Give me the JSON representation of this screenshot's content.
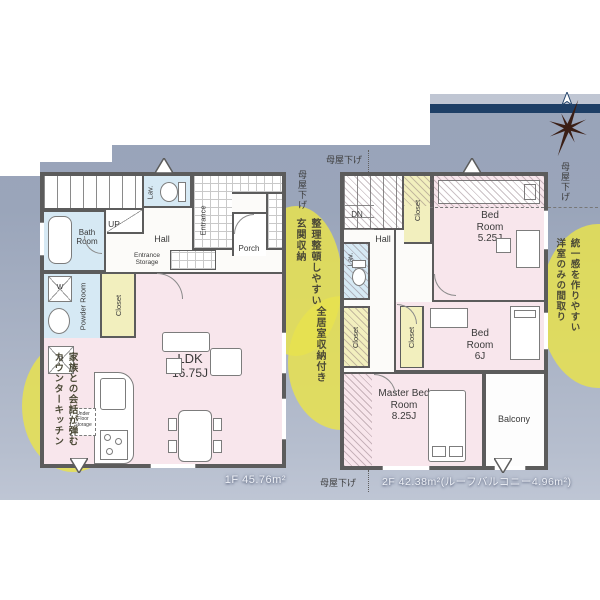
{
  "palette": {
    "background_panel_top": "#97a2b8",
    "background_panel_bottom": "#ccd2df",
    "navy_stripe": "#1e3f66",
    "callout_yellow": "#e7e24f",
    "room_pink": "#f8e6ec",
    "room_blue": "#d6e9f4",
    "closet_yellow": "#f2efbe",
    "wall_gray": "#5c5c5c",
    "compass_brown": "#3a1e15"
  },
  "eaves": {
    "label": "母屋下げ"
  },
  "floor1": {
    "area_label": "1F 45.76m²",
    "labels": {
      "up": "UP",
      "lav": "Lav.",
      "hall": "Hall",
      "bath": "Bath Room",
      "powder": "Powder Room",
      "closet": "Closet",
      "entrance": "Entrance",
      "entrance_storage": "Entrance Storage",
      "porch": "Porch",
      "ldk_name": "LDK",
      "ldk_size": "16.75J",
      "under_floor_storage": "Under Floor Storage",
      "washer": "W",
      "fridge": "R"
    }
  },
  "floor2": {
    "area_label": "2F 42.38m²(ルーフバルコニー4.96m²)",
    "labels": {
      "dn": "DN",
      "hall": "Hall",
      "lav": "Lav.",
      "closet_top": "Closet",
      "closet_left": "Closet",
      "closet_mid": "Closet",
      "bed1_name": "Bed Room",
      "bed1_size": "5.25J",
      "bed2_name": "Bed Room",
      "bed2_size": "6J",
      "master_name": "Master Bed Room",
      "master_size": "8.25J",
      "balcony": "Balcony"
    }
  },
  "callouts": {
    "entrance_storage": {
      "line1": "整理整頓しやすい",
      "line2": "玄関収納"
    },
    "counter_kitchen": {
      "line1": "家族との会話が弾む",
      "line2": "カウンターキッチン"
    },
    "all_rooms_storage": {
      "line1": "全居室収納付き"
    },
    "western_rooms": {
      "line1": "統一感を作りやすい",
      "line2": "洋室のみの間取り"
    }
  }
}
